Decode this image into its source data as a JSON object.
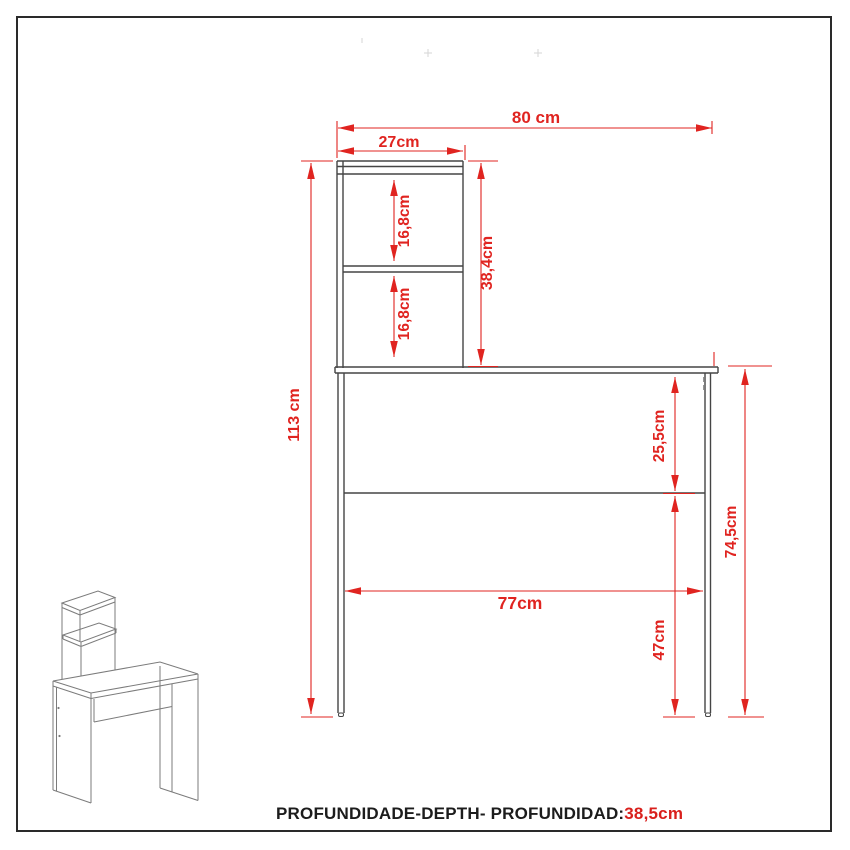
{
  "footer": {
    "label": "PROFUNDIDADE-DEPTH- PROFUNDIDAD:",
    "value": "38,5cm"
  },
  "dimensions": {
    "top_width": "80 cm",
    "hutch_width": "27cm",
    "upper_compartment_height": "16,8cm",
    "lower_compartment_height": "16,8cm",
    "hutch_height": "38,4cm",
    "overall_height": "113 cm",
    "top_to_stretcher": "25,5cm",
    "desk_height": "74,5cm",
    "clear_width_between_legs": "77cm",
    "stretcher_to_floor": "47cm"
  },
  "colors": {
    "dimension_red": "#e02420",
    "outline_dark": "#454545",
    "isometric_gray": "#7b7b7b",
    "frame_border": "#2a2a2a"
  }
}
